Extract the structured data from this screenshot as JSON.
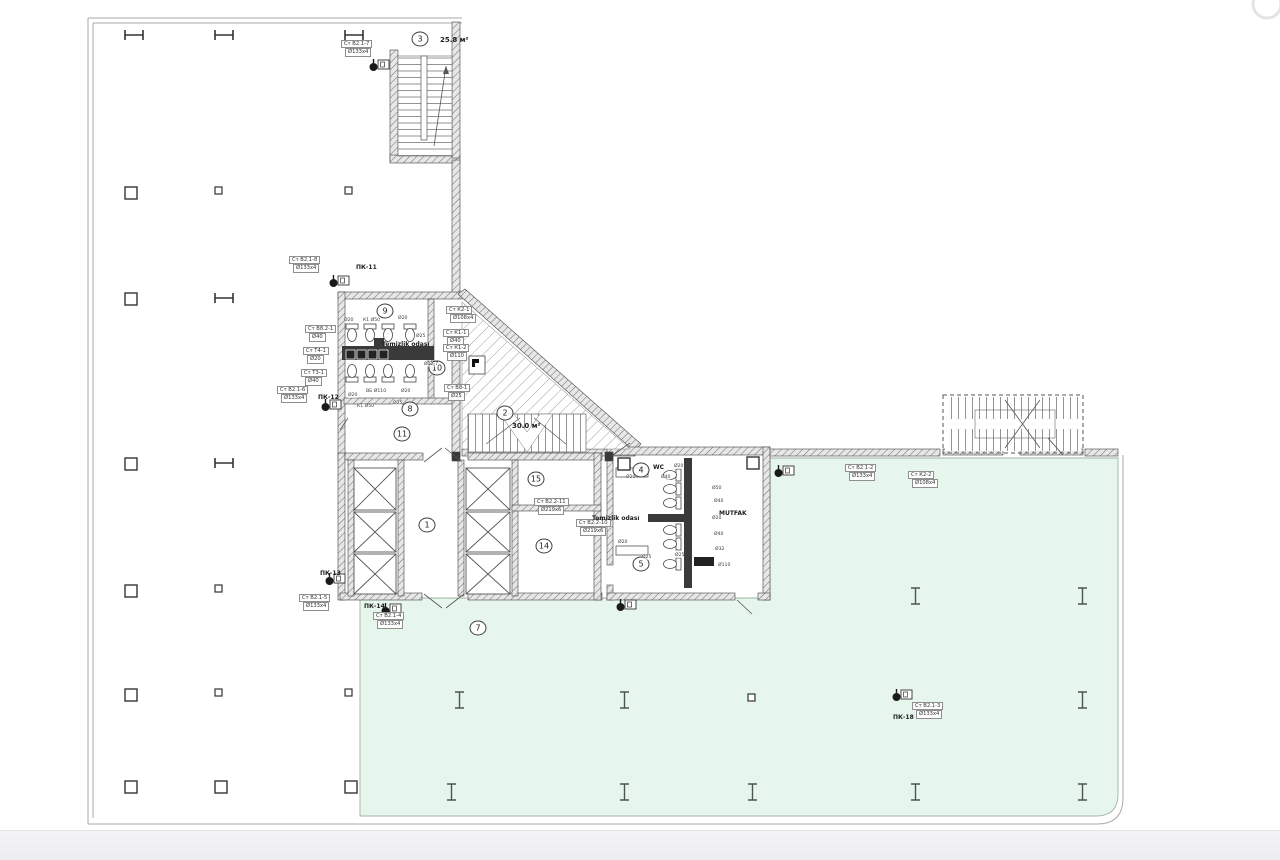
{
  "plan": {
    "colors": {
      "green_zone": "#e7f6ec",
      "green_border": "#9fb3a5",
      "wall_line": "#444444",
      "hatch_fill": "#e7e7e7",
      "dark_wall": "#3a3a3a",
      "boundary": "#a9a9a9"
    },
    "rooms": [
      {
        "num": "3",
        "x": 420,
        "y": 39,
        "area": "25.8 м²",
        "ax": 440,
        "ay": 40
      },
      {
        "num": "2",
        "x": 505,
        "y": 413,
        "area": "30.0 м²",
        "ax": 512,
        "ay": 426
      },
      {
        "num": "9",
        "x": 385,
        "y": 311
      },
      {
        "num": "10",
        "x": 437,
        "y": 368
      },
      {
        "num": "8",
        "x": 410,
        "y": 409
      },
      {
        "num": "11",
        "x": 402,
        "y": 434
      },
      {
        "num": "1",
        "x": 427,
        "y": 525
      },
      {
        "num": "15",
        "x": 536,
        "y": 479
      },
      {
        "num": "14",
        "x": 544,
        "y": 546
      },
      {
        "num": "4",
        "x": 641,
        "y": 470
      },
      {
        "num": "5",
        "x": 641,
        "y": 564
      },
      {
        "num": "7",
        "x": 478,
        "y": 628
      }
    ],
    "riser_labels": [
      {
        "l1": "Ст В2.1-7",
        "l2": "Ø133x4",
        "x": 341,
        "y": 40
      },
      {
        "l1": "Ст В2.1-8",
        "l2": "Ø133x4",
        "x": 289,
        "y": 256
      },
      {
        "l1": "Ст В8.2-1",
        "l2": "Ø40",
        "x": 305,
        "y": 325
      },
      {
        "l1": "Ст Т4-1",
        "l2": "Ø20",
        "x": 303,
        "y": 347
      },
      {
        "l1": "Ст Т3-1",
        "l2": "Ø40",
        "x": 301,
        "y": 369
      },
      {
        "l1": "Ст В2.1-6",
        "l2": "Ø133x4",
        "x": 277,
        "y": 386
      },
      {
        "l1": "Ст К2-1",
        "l2": "Ø108x4",
        "x": 446,
        "y": 306
      },
      {
        "l1": "Ст К1-1",
        "l2": "Ø40",
        "x": 443,
        "y": 329
      },
      {
        "l1": "Ст К1-2",
        "l2": "Ø110",
        "x": 443,
        "y": 344
      },
      {
        "l1": "Ст В8-1",
        "l2": "Ø25",
        "x": 444,
        "y": 384
      },
      {
        "l1": "Ст В2.2-11",
        "l2": "Ø219x6",
        "x": 534,
        "y": 498
      },
      {
        "l1": "Ст В2.2-10",
        "l2": "Ø219x6",
        "x": 576,
        "y": 519
      },
      {
        "l1": "Ст В2.1-5",
        "l2": "Ø133x4",
        "x": 299,
        "y": 594
      },
      {
        "l1": "Ст В2.1-4",
        "l2": "Ø133x4",
        "x": 373,
        "y": 612
      },
      {
        "l1": "Ст В2.1-2",
        "l2": "Ø133x4",
        "x": 845,
        "y": 464
      },
      {
        "l1": "Ст К2-2",
        "l2": "Ø108x4",
        "x": 908,
        "y": 471
      },
      {
        "l1": "Ст В2.1-3",
        "l2": "Ø133x4",
        "x": 912,
        "y": 702
      }
    ],
    "pk_labels": [
      {
        "text": "ПК-11",
        "x": 356,
        "y": 264
      },
      {
        "text": "ПК-12",
        "x": 318,
        "y": 394
      },
      {
        "text": "ПК-13",
        "x": 320,
        "y": 570
      },
      {
        "text": "ПК-14",
        "x": 364,
        "y": 603
      },
      {
        "text": "ПК-18",
        "x": 893,
        "y": 714
      }
    ],
    "room_texts": [
      {
        "text": "WC",
        "x": 653,
        "y": 464
      },
      {
        "text": "MUTFAK",
        "x": 719,
        "y": 510
      },
      {
        "text": "Temizlik odası",
        "x": 382,
        "y": 341
      },
      {
        "text": "Temizlik odası",
        "x": 592,
        "y": 515
      }
    ],
    "micro_labels": [
      {
        "t": "Ø20",
        "x": 344,
        "y": 318
      },
      {
        "t": "К1 Ø50",
        "x": 363,
        "y": 318
      },
      {
        "t": "Ø20",
        "x": 398,
        "y": 316
      },
      {
        "t": "Ø25",
        "x": 416,
        "y": 334
      },
      {
        "t": "Ø12-7",
        "x": 424,
        "y": 362
      },
      {
        "t": "ВБ Ø110",
        "x": 366,
        "y": 389
      },
      {
        "t": "Ø20",
        "x": 348,
        "y": 393
      },
      {
        "t": "Ø20",
        "x": 401,
        "y": 389
      },
      {
        "t": "Ø25",
        "x": 393,
        "y": 401
      },
      {
        "t": "К1 Ø50",
        "x": 357,
        "y": 404
      },
      {
        "t": "Ø20",
        "x": 626,
        "y": 475
      },
      {
        "t": "Ø40",
        "x": 661,
        "y": 475
      },
      {
        "t": "Ø20",
        "x": 674,
        "y": 464
      },
      {
        "t": "Ø50",
        "x": 712,
        "y": 486
      },
      {
        "t": "Ø40",
        "x": 714,
        "y": 499
      },
      {
        "t": "Ø20",
        "x": 712,
        "y": 516
      },
      {
        "t": "Ø40",
        "x": 714,
        "y": 532
      },
      {
        "t": "Ø32",
        "x": 715,
        "y": 547
      },
      {
        "t": "Ø110",
        "x": 718,
        "y": 563
      },
      {
        "t": "Ø20",
        "x": 618,
        "y": 540
      },
      {
        "t": "Ø25",
        "x": 642,
        "y": 555
      },
      {
        "t": "Ø25",
        "x": 675,
        "y": 553
      }
    ],
    "columns": {
      "h_beams": [
        [
          125,
          30
        ],
        [
          215,
          30
        ],
        [
          345,
          30
        ],
        [
          215,
          293
        ],
        [
          215,
          458
        ]
      ],
      "squares": [
        [
          125,
          187
        ],
        [
          125,
          293
        ],
        [
          125,
          458
        ],
        [
          125,
          585
        ],
        [
          125,
          689
        ],
        [
          125,
          781
        ],
        [
          215,
          781
        ],
        [
          345,
          781
        ],
        [
          618,
          458
        ],
        [
          747,
          457
        ]
      ],
      "small_squares": [
        [
          215,
          187
        ],
        [
          345,
          187
        ],
        [
          215,
          585
        ],
        [
          215,
          689
        ],
        [
          345,
          689
        ],
        [
          748,
          694
        ]
      ],
      "i_beams": [
        [
          911,
          588
        ],
        [
          1078,
          588
        ],
        [
          455,
          692
        ],
        [
          620,
          692
        ],
        [
          1078,
          692
        ],
        [
          447,
          784
        ],
        [
          620,
          784
        ],
        [
          748,
          784
        ],
        [
          911,
          784
        ],
        [
          1078,
          784
        ]
      ]
    },
    "toilets": [
      {
        "x": 352,
        "y": 334,
        "r": 180
      },
      {
        "x": 370,
        "y": 334,
        "r": 180
      },
      {
        "x": 388,
        "y": 334,
        "r": 180
      },
      {
        "x": 410,
        "y": 334,
        "r": 180
      },
      {
        "x": 352,
        "y": 372,
        "r": 0
      },
      {
        "x": 370,
        "y": 372,
        "r": 0
      },
      {
        "x": 388,
        "y": 372,
        "r": 0
      },
      {
        "x": 410,
        "y": 372,
        "r": 0
      },
      {
        "x": 671,
        "y": 475,
        "r": -90
      },
      {
        "x": 671,
        "y": 489,
        "r": -90
      },
      {
        "x": 671,
        "y": 503,
        "r": -90
      },
      {
        "x": 671,
        "y": 530,
        "r": -90
      },
      {
        "x": 671,
        "y": 544,
        "r": -90
      },
      {
        "x": 671,
        "y": 564,
        "r": -90
      }
    ],
    "urinals": [
      [
        346,
        350
      ],
      [
        357,
        350
      ],
      [
        368,
        350
      ],
      [
        379,
        350
      ]
    ],
    "hose_cabinets": [
      [
        330,
        276
      ],
      [
        322,
        400
      ],
      [
        326,
        574
      ],
      [
        382,
        604
      ],
      [
        893,
        690
      ],
      [
        370,
        60
      ],
      [
        775,
        466
      ],
      [
        617,
        600
      ]
    ]
  }
}
